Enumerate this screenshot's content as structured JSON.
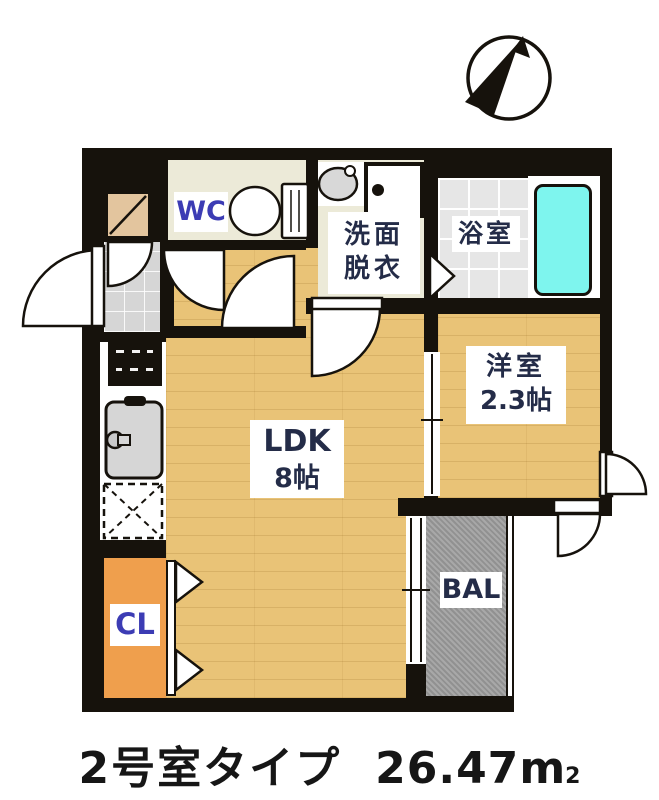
{
  "compass": {
    "icon": "north-arrow"
  },
  "rooms": {
    "wc": {
      "label": "WC"
    },
    "washroom": {
      "line1": "洗面",
      "line2": "脱衣"
    },
    "bath": {
      "label": "浴室"
    },
    "western": {
      "line1": "洋室",
      "line2": "2.3帖"
    },
    "ldk": {
      "line1": "LDK",
      "line2": "8帖"
    },
    "closet": {
      "label": "CL"
    },
    "balcony": {
      "label": "BAL"
    }
  },
  "fixtures": [
    "toilet",
    "vanity-sink",
    "washer-pan",
    "bathtub",
    "stove",
    "kitchen-sink",
    "refrigerator",
    "shoe-cabinet"
  ],
  "caption": {
    "title": "2号室タイプ",
    "area_value": "26.47",
    "area_unit": "m",
    "area_sup": "2"
  },
  "colors": {
    "wall": "#16120c",
    "wood_floor": "#E9C377",
    "cream_floor": "#ECEAD8",
    "bath_tile": "#E6E6E6",
    "genkan_tile": "#D6D6D6",
    "balcony_gray": "#9C9C9C",
    "closet_orange": "#EF9F4D",
    "bathtub_cyan": "#7EF5EE",
    "label_navy": "#242c48",
    "label_blue": "#3c3cb4"
  }
}
